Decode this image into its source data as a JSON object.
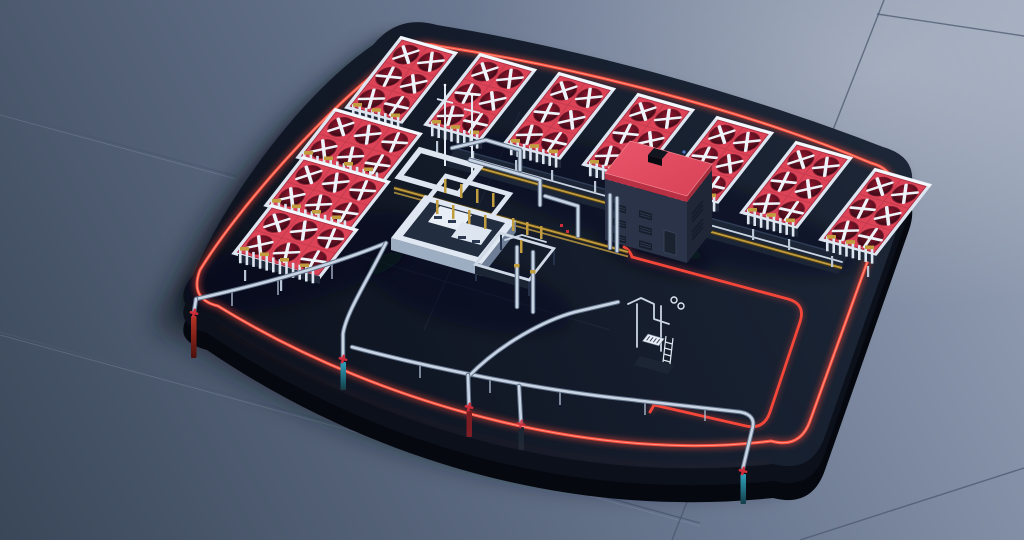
{
  "scene": {
    "description": "Isometric 3D render of a miniature industrial cooling plant standing on a dark rounded slab with a glowing red perimeter strip, placed on a large blue-grey tiled floor",
    "floor": {
      "material": "glossy blue-grey tiles",
      "visible_tile_seams": 5
    },
    "platform": {
      "shape": "rounded rectangle slab",
      "edge_strip": "glowing red inset border",
      "thickness_px": 34
    },
    "cooler_units": {
      "top_row_count": 7,
      "left_column_count": 3,
      "fans_per_unit": 6,
      "fan_style": "dark circular fan with white X blades on red deck",
      "support": "white finned frame with gold headers"
    },
    "building": {
      "roof": "red flat roof with dark chimney",
      "walls": "dark navy with louvered vents",
      "vent_panels": 8
    },
    "equipment": [
      "pipe-rack",
      "process-skid-a",
      "process-skid-b",
      "pump-unit",
      "flare-masts",
      "white-pipe-frames"
    ],
    "pipes": {
      "silver_deck_runs": 4,
      "red_deck_loop": 1,
      "gold_lines": 2
    },
    "edge_risers": [
      {
        "position": "west-corner",
        "valve": "red",
        "tube": "red"
      },
      {
        "position": "south-1",
        "valve": "red",
        "tube": "teal"
      },
      {
        "position": "south-2",
        "valve": "red",
        "tube": "dark-red"
      },
      {
        "position": "south-3",
        "valve": "dark-red",
        "tube": "dark"
      },
      {
        "position": "south-east-corner",
        "valve": "red",
        "tube": "teal"
      }
    ]
  },
  "colors": {
    "floorLight": "#9aa5b9",
    "floorMid": "#68768f",
    "floorDark": "#3a4759",
    "seam": "#4a576e",
    "platformTop": "#1e2939",
    "platformDark": "#0c111c",
    "platformMid": "#0b101a",
    "platformSide": "#05080e",
    "accentRed": "#fa4b3a",
    "accentGlow": "#ff9a88",
    "deckRed": "#dc4356",
    "fanDark": "#2b0714",
    "fanGlow": "#97152e",
    "blade": "#eef3f9",
    "frame": "#dde6f0",
    "frameBright": "#f4f8fc",
    "finDark": "#1f2838",
    "gold": "#c29d40",
    "pipe": "#c9d4e3",
    "pipeDark": "#5f7089",
    "roof": "#e9556a",
    "roofDark": "#b83043",
    "wall": "#2a3347",
    "wallDark": "#1f2737",
    "vent": "#141b29",
    "skidWhite": "#dfe8f2",
    "skidTop": "#232d40",
    "teal": "#2fa3bd",
    "valveRed": "#cf2d3a",
    "tubeRed": "#b63326",
    "tubeDarkRed": "#7c1d24",
    "rackDark": "#1c2535",
    "shadow": "#070c15"
  }
}
